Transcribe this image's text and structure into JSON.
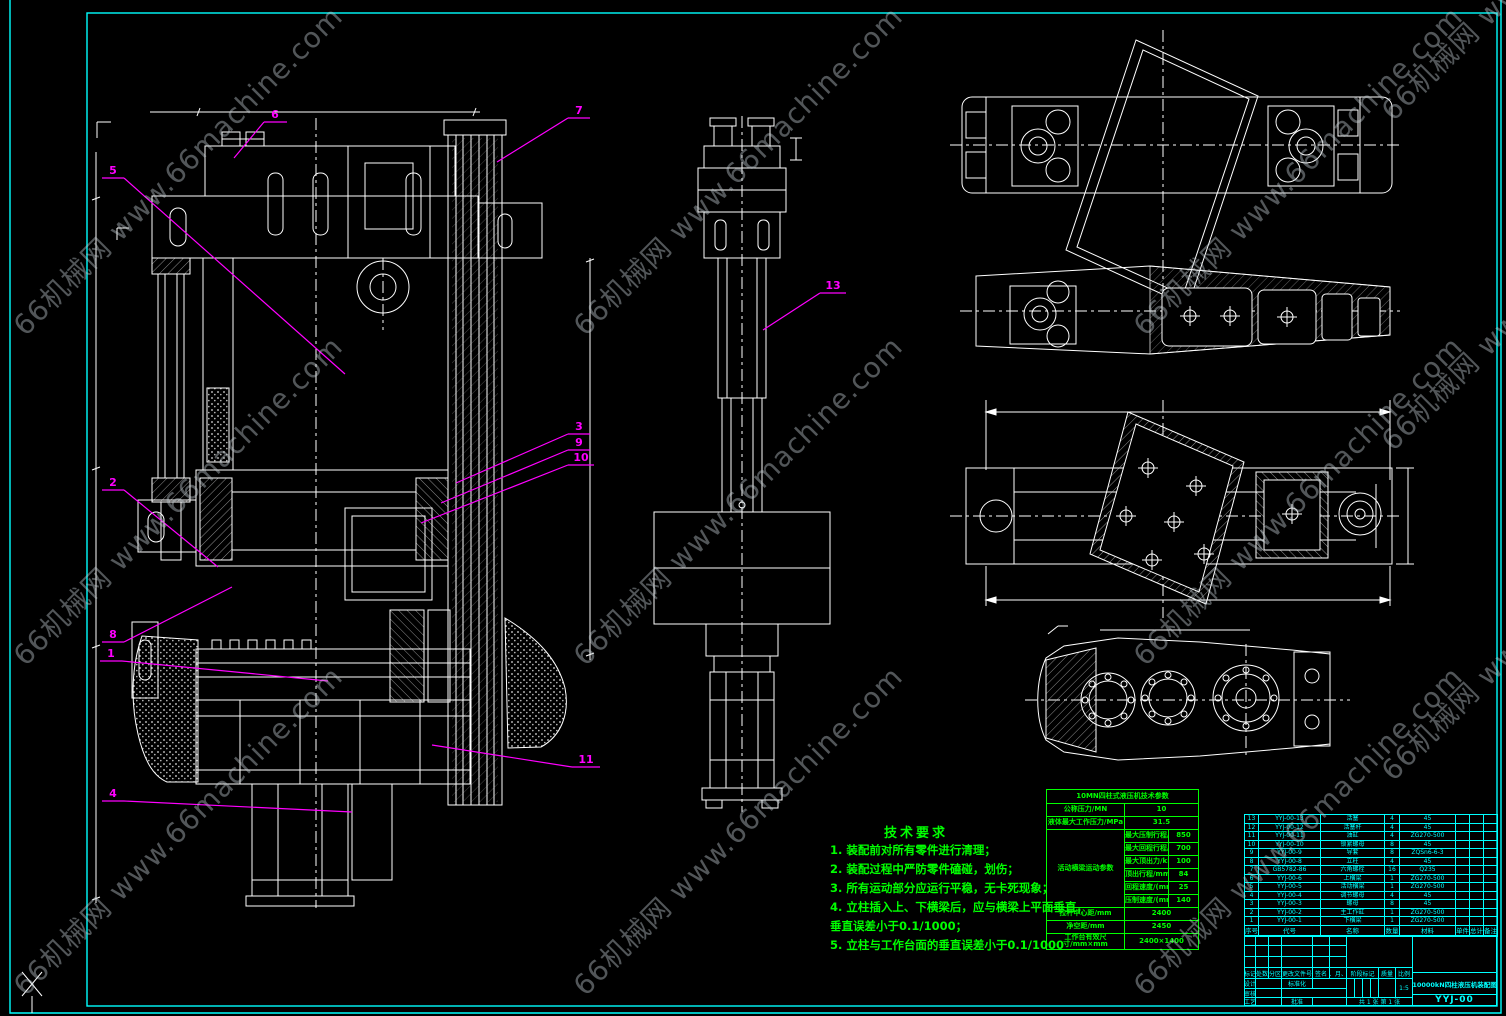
{
  "colors": {
    "background": "#000000",
    "line": "#ffffff",
    "frame": "#00ffff",
    "callout": "#ff00ff",
    "notes": "#00ff00",
    "bom": "#00ffff",
    "watermark": "#c3ced4"
  },
  "watermark": {
    "text": "66机械网 www.66machine.com"
  },
  "notes": {
    "title": "技术要求",
    "lines": [
      "1. 装配前对所有零件进行清理；",
      "2. 装配过程中严防零件磕碰，划伤；",
      "3. 所有运动部分应运行平稳，无卡死现象；",
      "4. 立柱插入上、下横梁后，应与横梁上平面垂直，",
      "垂直误差小于0.1/1000；",
      "5. 立柱与工作台面的垂直误差小于0.1/1000"
    ]
  },
  "spec_table": {
    "title": "10MN四柱式液压机技术参数",
    "rows_top": [
      [
        "公称压力/MN",
        "10"
      ],
      [
        "液体最大工作压力/MPa",
        "31.5"
      ]
    ],
    "group_label": "活动横梁运动参数",
    "group_rows": [
      [
        "最大压制行程/mm",
        "850"
      ],
      [
        "最大回程行程/mm",
        "700"
      ],
      [
        "最大顶出力/kN",
        "100"
      ],
      [
        "顶出行程/mm",
        "84"
      ],
      [
        "回程速度/(mm/s)",
        "25"
      ],
      [
        "压制速度/(mm/s)",
        "140"
      ]
    ],
    "rows_bottom": [
      [
        "拉杆中心距/mm",
        "2400"
      ],
      [
        "净空距/mm",
        "2450"
      ],
      [
        "工作台有效尺寸/mm×mm",
        "2400×1400"
      ]
    ]
  },
  "bom": {
    "headers": [
      "序号",
      "代号",
      "名称",
      "数量",
      "材料",
      "单件",
      "总计",
      "备注"
    ],
    "rows": [
      [
        "13",
        "YYJ-00-13",
        "活塞",
        "4",
        "45",
        "",
        "",
        ""
      ],
      [
        "12",
        "YYJ-00-12",
        "活塞杆",
        "4",
        "45",
        "",
        "",
        ""
      ],
      [
        "11",
        "YYJ-00-11",
        "油缸",
        "4",
        "ZG270-500",
        "",
        "",
        ""
      ],
      [
        "10",
        "YYJ-00-10",
        "锁紧螺母",
        "8",
        "45",
        "",
        "",
        ""
      ],
      [
        "9",
        "YYJ-00-9",
        "导套",
        "8",
        "ZQSn6-6-3",
        "",
        "",
        ""
      ],
      [
        "8",
        "YYJ-00-8",
        "立柱",
        "4",
        "45",
        "",
        "",
        ""
      ],
      [
        "7",
        "GB5782-86",
        "六角螺栓",
        "16",
        "Q235",
        "",
        "",
        ""
      ],
      [
        "6",
        "YYJ-00-6",
        "上横梁",
        "1",
        "ZG270-500",
        "",
        "",
        ""
      ],
      [
        "5",
        "YYJ-00-5",
        "活动横梁",
        "1",
        "ZG270-500",
        "",
        "",
        ""
      ],
      [
        "4",
        "YYJ-00-4",
        "调节螺母",
        "4",
        "45",
        "",
        "",
        ""
      ],
      [
        "3",
        "YYJ-00-3",
        "螺母",
        "8",
        "45",
        "",
        "",
        ""
      ],
      [
        "2",
        "YYJ-00-2",
        "主工作缸",
        "1",
        "ZG270-500",
        "",
        "",
        ""
      ],
      [
        "1",
        "YYJ-00-1",
        "下横梁",
        "1",
        "ZG270-500",
        "",
        "",
        ""
      ]
    ]
  },
  "title_block": {
    "update_cols": [
      "标记",
      "处数",
      "分区",
      "更改文件号",
      "签名",
      "年、月、日"
    ],
    "design_label": "设计",
    "check_label": "审核",
    "process_label": "工艺",
    "standard_label": "标准化",
    "approve_label": "批准",
    "stage_label": "阶段标记",
    "weight_label": "质量",
    "scale_label": "比例",
    "scale_value": "1:5",
    "sheet_info": "共 1 张  第 1 张",
    "title": "10000kN四柱液压机装配图",
    "drawing_no": "YYJ-00"
  },
  "callouts": [
    {
      "label": "6"
    },
    {
      "label": "7"
    },
    {
      "label": "5"
    },
    {
      "label": "2"
    },
    {
      "label": "8"
    },
    {
      "label": "1"
    },
    {
      "label": "4"
    },
    {
      "label": "3"
    },
    {
      "label": "9"
    },
    {
      "label": "10"
    },
    {
      "label": "11"
    },
    {
      "label": "13"
    }
  ]
}
